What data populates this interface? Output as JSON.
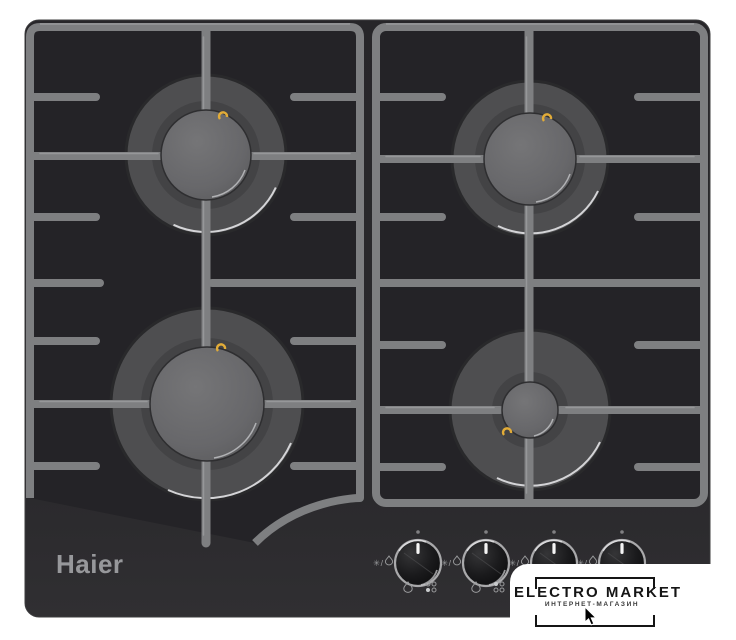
{
  "image": {
    "description": "Haier built-in 4-burner gas hob, black glass, cast-iron grates, product photo",
    "background": "#ffffff"
  },
  "brand": {
    "logo_text": "Haier",
    "logo_color": "#97989b"
  },
  "hob": {
    "body_color": "#2a292c",
    "grate_color": "#7e7f81",
    "burner_ring_color": "#4e4e50",
    "burner_cap_color": "#69696b",
    "igniter_color": "#e2ac38",
    "burners": [
      {
        "id": "rear-left",
        "size": "semi-rapid"
      },
      {
        "id": "rear-right",
        "size": "semi-rapid"
      },
      {
        "id": "front-left",
        "size": "rapid"
      },
      {
        "id": "front-right",
        "size": "auxiliary"
      }
    ],
    "knobs": {
      "count": 4,
      "ignition_symbol": "✳/",
      "positions": [
        "front-left",
        "rear-left",
        "rear-right",
        "front-right"
      ],
      "indicator_state": "off, pointer at 12 o'clock"
    }
  },
  "watermark": {
    "title": "ELECTRO MARKET",
    "subtitle": "ИНТЕРНЕТ-МАГАЗИН",
    "text_color": "#151515",
    "panel_color": "#ffffff"
  },
  "cursor": {
    "type": "arrow-pointer"
  }
}
